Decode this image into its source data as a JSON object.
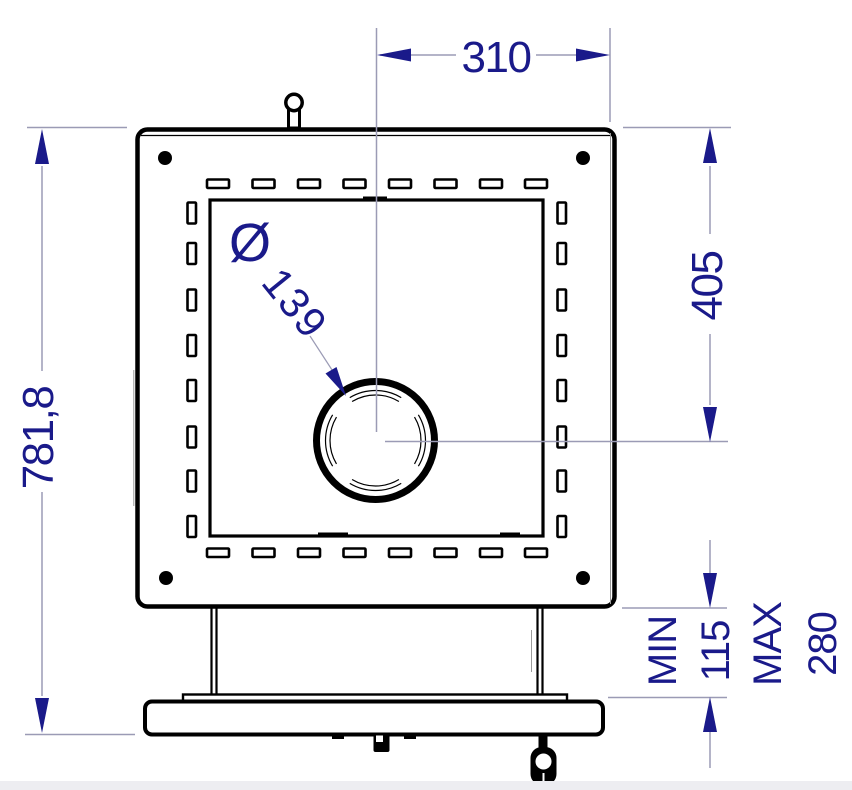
{
  "drawing": {
    "dimensions": {
      "top_width": "310",
      "right_height": "405",
      "overall_height": "781,8",
      "gap_min_label": "MIN",
      "gap_min_value": "115",
      "gap_max_label": "MAX",
      "gap_max_value": "280",
      "port_diameter_symbol": "Ø",
      "port_diameter_value": "139"
    }
  },
  "colors": {
    "dimension": "#1a1a8a",
    "dimension_line": "#9b9bb5",
    "outline": "#000000",
    "background": "#ffffff",
    "page_edge": "#ededf1"
  }
}
